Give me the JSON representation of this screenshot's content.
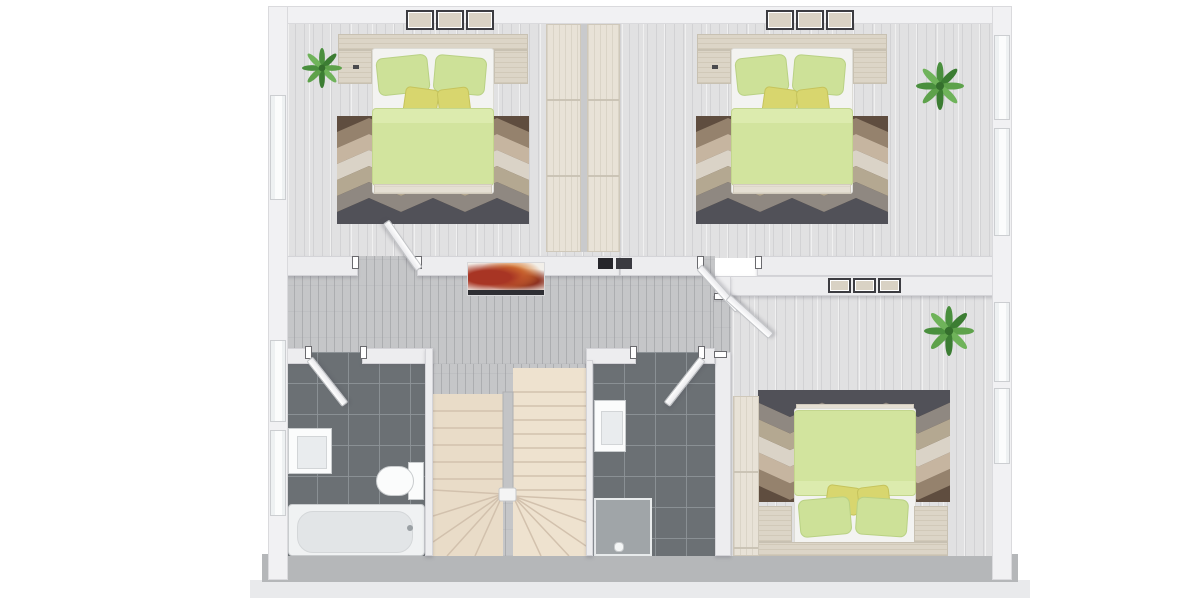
{
  "scene": {
    "kind": "3d-floor-plan-rendering",
    "view": "top-down dollhouse view of one storey",
    "visible_text": "none"
  },
  "palette": {
    "background": "#ffffff",
    "exterior_wall": "#f1f1f3",
    "bottom_wall_shadow": "#b5b7b9",
    "interior_wall": "#ededef",
    "bedroom_floor": "#e1e1e2",
    "hallway_floor": "#c5c6c8",
    "bathroom_tile": "#6b7074",
    "stair_tread": "#ecdfcd",
    "duvet_green": "#d2e49e",
    "pillow_green": "#cde198",
    "cushion_yellow": "#d8d66e",
    "wood_light": "#dcd5c7",
    "rug_colors": [
      "#5f4d3f",
      "#95826d",
      "#c6b5a0",
      "#dad3c7",
      "#b4a891",
      "#8f8881",
      "#515158"
    ],
    "plant_green": "#4a8f3e",
    "artwork_accent": "#a83524"
  },
  "rooms": [
    {
      "name": "bedroom-top-left",
      "floor": "light wood",
      "furniture": [
        "double bed with green duvet",
        "two green pillows",
        "two yellow cushions",
        "headboard shelf",
        "2 nightstands",
        "chevron rug",
        "tall wardrobe",
        "potted plant",
        "3 wall frames"
      ]
    },
    {
      "name": "bedroom-top-right",
      "floor": "light wood",
      "furniture": [
        "double bed with green duvet",
        "two green pillows",
        "two yellow cushions",
        "headboard shelf",
        "2 nightstands",
        "chevron rug",
        "tall wardrobe",
        "potted plant",
        "3 wall frames"
      ]
    },
    {
      "name": "bedroom-bottom-right",
      "floor": "light wood",
      "furniture": [
        "double bed with green duvet (head at bottom wall)",
        "two green pillows",
        "two yellow cushions",
        "2 nightstands",
        "chevron rug",
        "tall wardrobe",
        "potted plant",
        "3 wall frames"
      ]
    },
    {
      "name": "bathroom-left",
      "floor": "dark grey tile",
      "fixtures": [
        "vanity sink",
        "toilet",
        "bathtub"
      ]
    },
    {
      "name": "bathroom-middle",
      "floor": "dark grey tile",
      "fixtures": [
        "vanity sink",
        "shower"
      ]
    },
    {
      "name": "hallway",
      "floor": "grey wood",
      "decor": [
        "red abstract artwork on wall",
        "two dark wall panels"
      ]
    },
    {
      "name": "stairwell",
      "stairs": "U-shaped staircase, two flights with winder steps, beige treads, centre spine wall"
    }
  ],
  "openings": {
    "doors": 5,
    "windows_left_wall": 3,
    "windows_right_wall": 4
  }
}
